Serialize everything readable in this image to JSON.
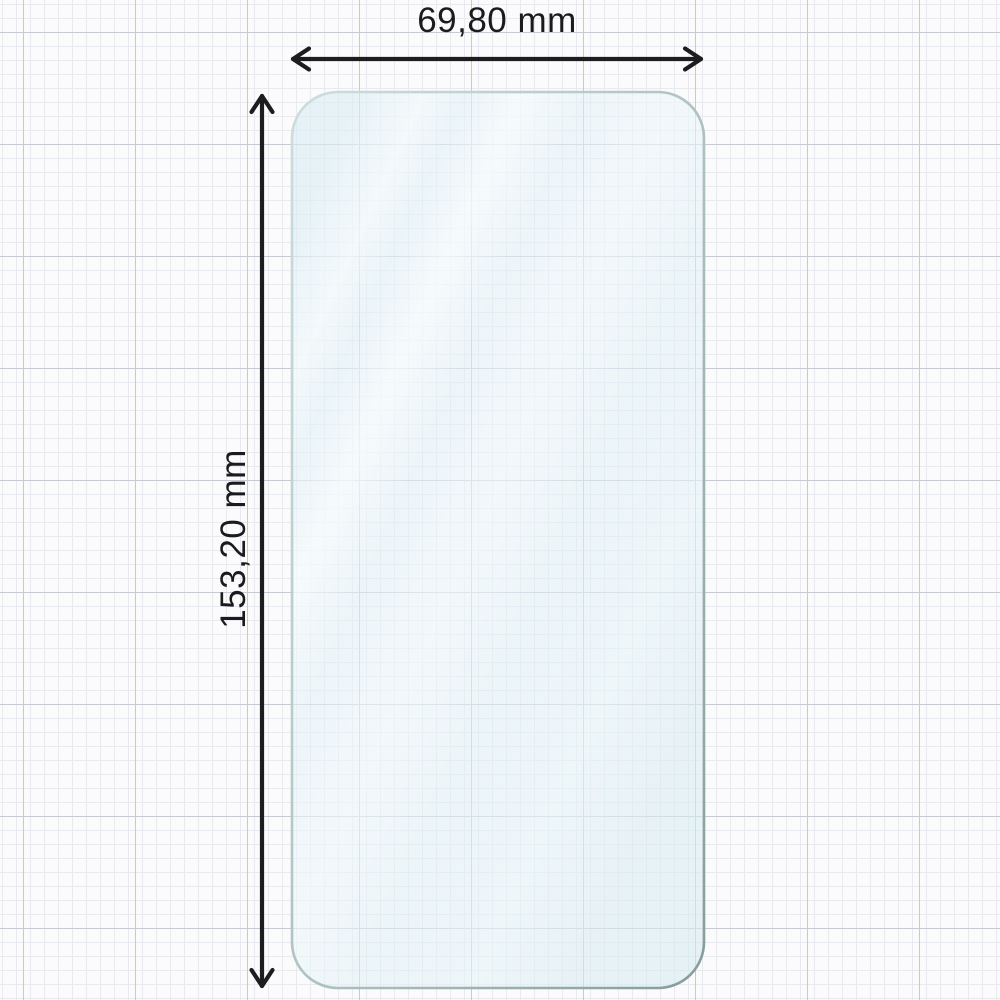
{
  "figure": {
    "type": "product-dimension-diagram",
    "subject": "smartphone screen protector film on graph paper",
    "width_dimension": {
      "label": "69,80 mm"
    },
    "height_dimension": {
      "label": "153,20 mm"
    }
  },
  "colors": {
    "background": "#fbfbfc",
    "grid_minor": "#e8eaef",
    "grid_major": "#c6cad2",
    "arrow": "#1d1d1f",
    "label_text": "#1b1b1d",
    "glass_fill": "#e9f3f8",
    "glass_edge_light": "#cddddd",
    "glass_edge_dark": "#879c9a"
  }
}
